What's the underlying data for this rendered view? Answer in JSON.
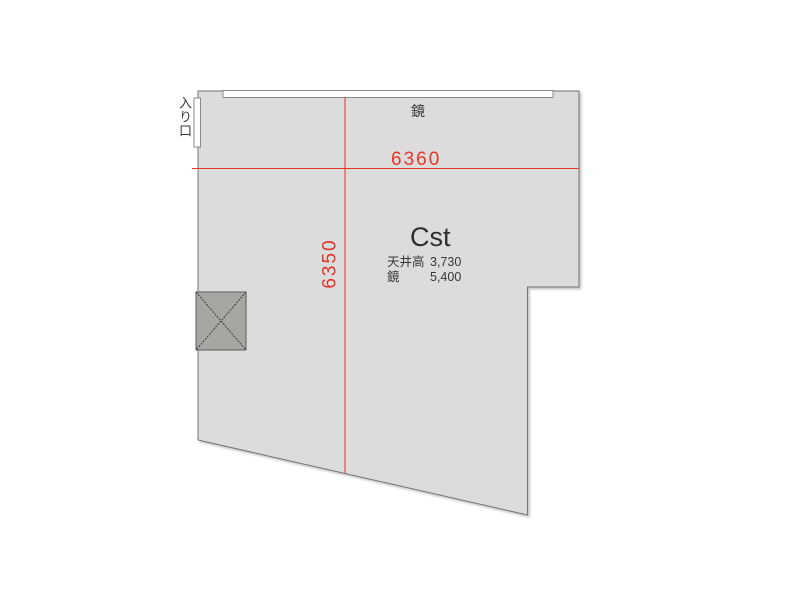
{
  "floorplan": {
    "entrance_label": "入り口",
    "mirror_label": "鏡",
    "dimensions": {
      "width_mm": "6360",
      "height_mm": "6350"
    },
    "studio": {
      "name": "Cst",
      "specs": [
        {
          "label": "天井高",
          "value": "3,730"
        },
        {
          "label": "鏡",
          "value": "5,400"
        }
      ]
    },
    "icons": [
      "pillar-x-marker"
    ],
    "colors": {
      "dimension_red": "#e5352b",
      "room_fill": "#dcdcdc",
      "wall_stroke": "#757575",
      "pillar_fill": "#a8a6a3",
      "mirror_fill": "#ffffff",
      "text": "#383838"
    }
  }
}
